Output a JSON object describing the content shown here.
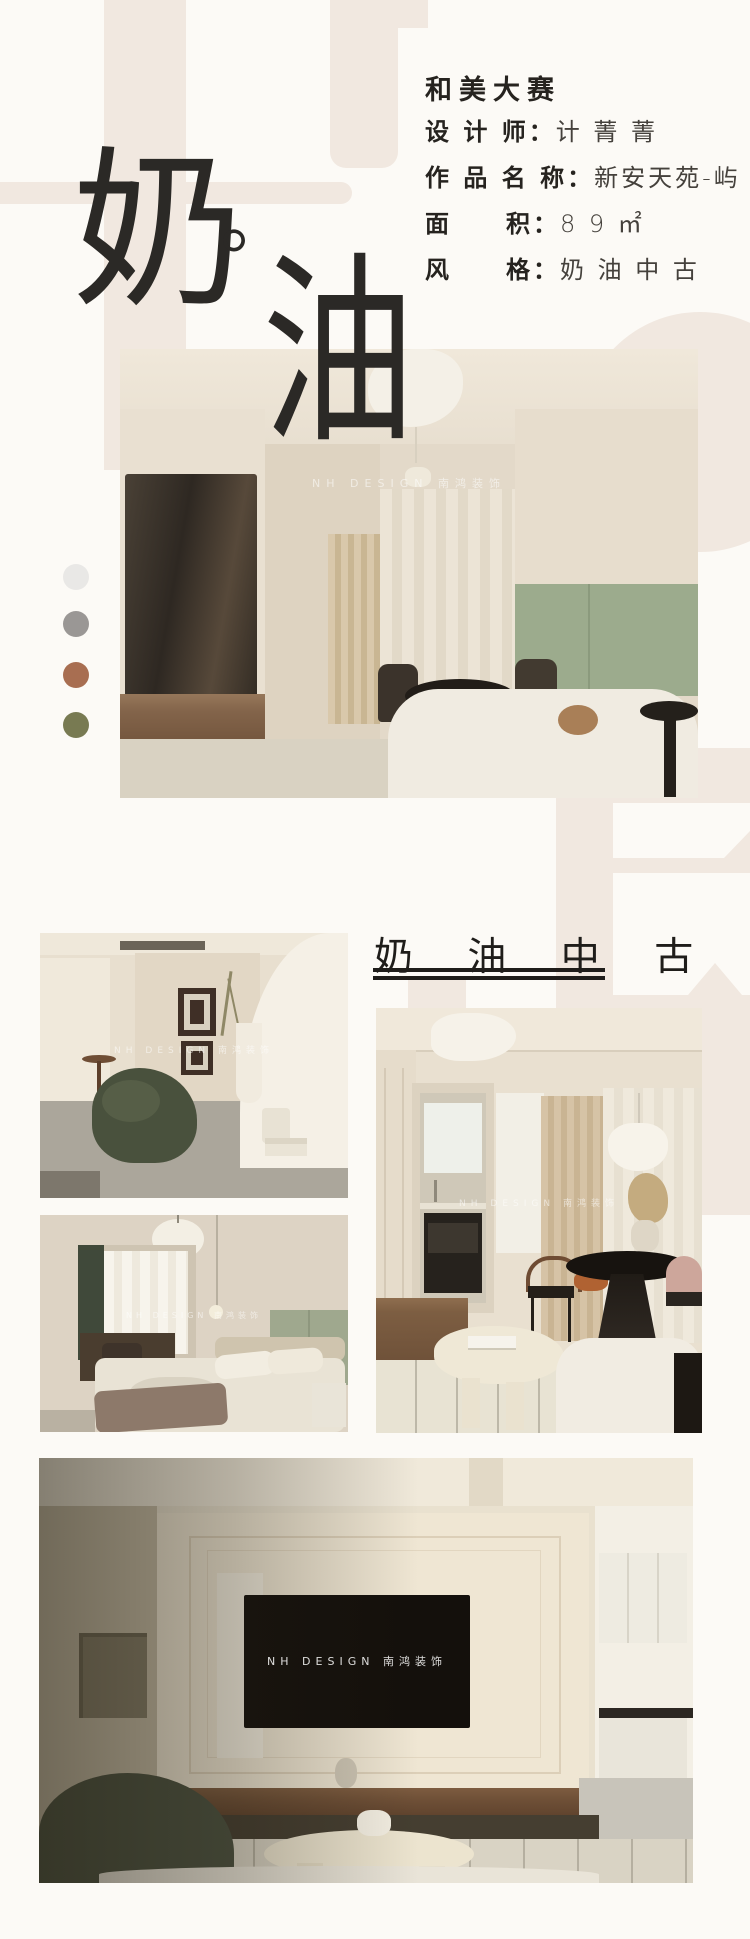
{
  "page": {
    "bg": "#fcfaf6",
    "beige": "#f1e8e0",
    "ink": "#2b2926"
  },
  "hero": {
    "char_top": "奶",
    "dot": "。",
    "char_bottom": "油"
  },
  "info_card": {
    "title": "和美大赛",
    "rows": [
      {
        "label": "设 计 师：",
        "value": "计 菁 菁"
      },
      {
        "label": "作 品 名 称：",
        "value": "新安天苑-屿"
      },
      {
        "label": "面　　积：",
        "value": "8 9 ㎡"
      },
      {
        "label": "风　　格：",
        "value": "奶 油 中 古"
      }
    ]
  },
  "palette": [
    {
      "name": "light-gray",
      "hex": "#e9e8e6"
    },
    {
      "name": "warm-gray",
      "hex": "#9a9795"
    },
    {
      "name": "terracotta",
      "hex": "#a86e51"
    },
    {
      "name": "olive-green",
      "hex": "#787a52"
    }
  ],
  "section": {
    "title": "奶 油 中 古"
  },
  "watermark": {
    "text": "NH DESIGN 南鸿装饰"
  }
}
